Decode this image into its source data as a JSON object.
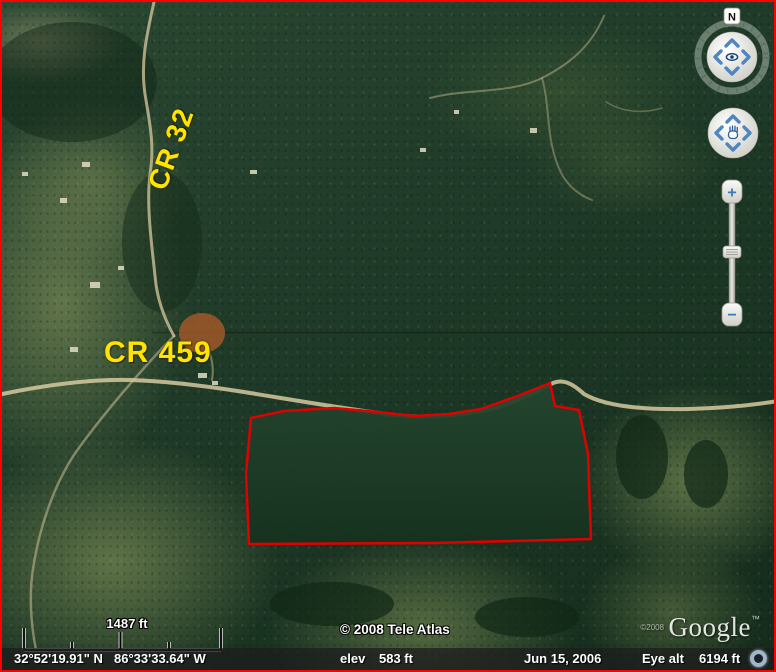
{
  "app": {
    "name": "Google Earth satellite view"
  },
  "map_labels": {
    "cr32": "CR 32",
    "cr459": "CR 459",
    "label_color": "#ffe400"
  },
  "parcel": {
    "outline_color": "#e10000",
    "points": "249,416 282,409 332,406 366,409 412,414 447,412 479,407 513,395 548,381 553,404 577,408 586,452 589,537 430,541 247,542 244,472"
  },
  "nav": {
    "north_label": "N",
    "zoom_in": "+",
    "zoom_out": "−",
    "accent_blue": "#4f86c0"
  },
  "scale_bar": {
    "label": "1487 ft"
  },
  "copyright": {
    "tele_atlas": "© 2008 Tele Atlas",
    "google_small": "©2008",
    "google_logo": "Google",
    "tm": "™"
  },
  "status_bar": {
    "latitude": "32°52'19.91\" N",
    "longitude": "86°33'33.64\" W",
    "elev_label": "elev",
    "elev_value": "583 ft",
    "date": "Jun 15, 2006",
    "eye_alt_label": "Eye alt",
    "eye_alt_value": "6194 ft"
  }
}
